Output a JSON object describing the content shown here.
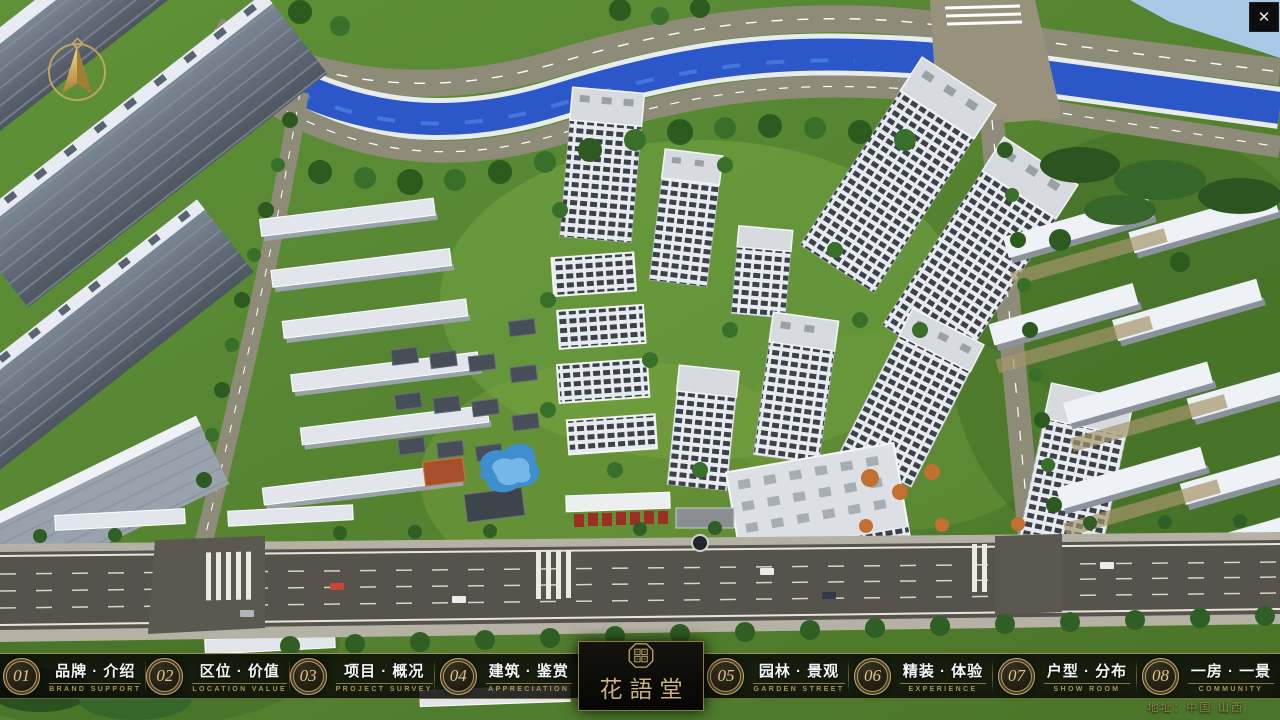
{
  "window": {
    "close_glyph": "✕"
  },
  "nav": {
    "items": [
      {
        "num": "01",
        "zh": "品牌 · 介绍",
        "en": "BRAND SUPPORT"
      },
      {
        "num": "02",
        "zh": "区位 · 价值",
        "en": "LOCATION VALUE"
      },
      {
        "num": "03",
        "zh": "项目 · 概况",
        "en": "PROJECT SURVEY"
      },
      {
        "num": "04",
        "zh": "建筑 · 鉴赏",
        "en": "APPRECIATION"
      },
      {
        "num": "05",
        "zh": "园林 · 景观",
        "en": "GARDEN STREET"
      },
      {
        "num": "06",
        "zh": "精装 · 体验",
        "en": "EXPERIENCE"
      },
      {
        "num": "07",
        "zh": "户型 · 分布",
        "en": "SHOW ROOM"
      },
      {
        "num": "08",
        "zh": "一房 · 一景",
        "en": "COMMUNITY"
      }
    ]
  },
  "logo": {
    "name": "花語堂",
    "subtext": "· · · · · · · · ·"
  },
  "footer": {
    "address": "地址：中国·山西"
  },
  "colors": {
    "gold": "#c9ab6e",
    "gold_dim": "#8f7b45",
    "bar_bg": "rgba(12,12,9,0.80)",
    "river": "#2b57c9",
    "grass": "#5d8f35",
    "road_top": "#8f8b79",
    "road_bottom": "#55534c"
  }
}
